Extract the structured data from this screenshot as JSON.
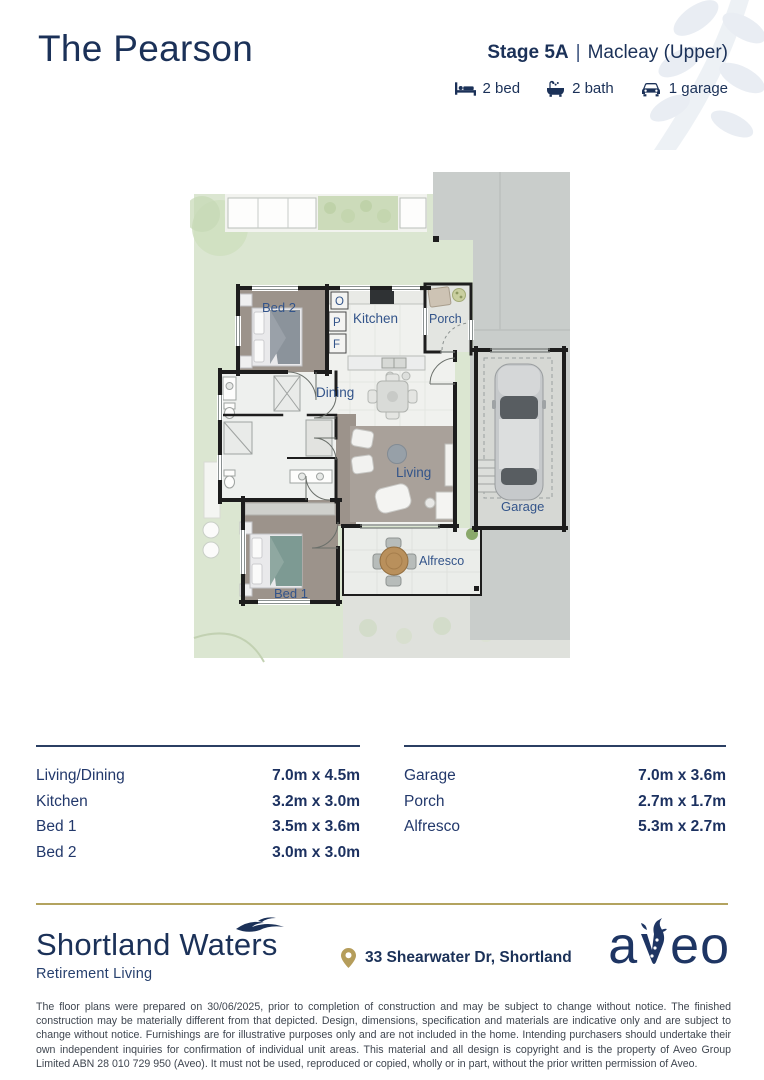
{
  "header": {
    "title": "The Pearson",
    "stage": "Stage 5A",
    "divider": "|",
    "variant": "Macleay (Upper)",
    "features": [
      {
        "icon": "bed-icon",
        "label": "2 bed"
      },
      {
        "icon": "bath-icon",
        "label": "2 bath"
      },
      {
        "icon": "car-icon",
        "label": "1 garage"
      }
    ]
  },
  "plan": {
    "labels": {
      "bed2": "Bed 2",
      "kitchen": "Kitchen",
      "porch": "Porch",
      "dining": "Dining",
      "living": "Living",
      "bed1": "Bed 1",
      "alfresco": "Alfresco",
      "garage": "Garage",
      "oven": "O",
      "pantry": "P",
      "fridge": "F"
    }
  },
  "dims": {
    "left": [
      {
        "room": "Living/Dining",
        "size": "7.0m x 4.5m"
      },
      {
        "room": "Kitchen",
        "size": "3.2m x 3.0m"
      },
      {
        "room": "Bed 1",
        "size": "3.5m x 3.6m"
      },
      {
        "room": "Bed 2",
        "size": "3.0m x 3.0m"
      }
    ],
    "right": [
      {
        "room": "Garage",
        "size": "7.0m x 3.6m"
      },
      {
        "room": "Porch",
        "size": "2.7m x 1.7m"
      },
      {
        "room": "Alfresco",
        "size": "5.3m x 2.7m"
      }
    ]
  },
  "footer": {
    "community_name": "Shortland Waters",
    "community_tagline": "Retirement Living",
    "address": "33 Shearwater Dr, Shortland",
    "brand": "aveo"
  },
  "disclaimer": "The floor plans were prepared on 30/06/2025, prior to completion of construction and may be subject to change without notice. The finished construction may be materially different from that depicted. Design, dimensions, specification and materials are indicative only and are subject to change without notice. Furnishings are for illustrative purposes only and are not included in the home. Intending purchasers should undertake their own independent inquiries for confirmation of individual unit areas. This material and all design is copyright and is the property of Aveo Group Limited ABN 28 010 729 950 (Aveo). It must not be used, reproduced or copied, wholly or in part, without the prior written permission of Aveo.",
  "colors": {
    "navy": "#1b3158",
    "gold": "#b3a35f",
    "garden_green": "#dbe6d1",
    "driveway_gray": "#c9cdcb",
    "floor_brown": "#9c938b",
    "wall_black": "#1d1d1d",
    "label_blue": "#33548a"
  }
}
